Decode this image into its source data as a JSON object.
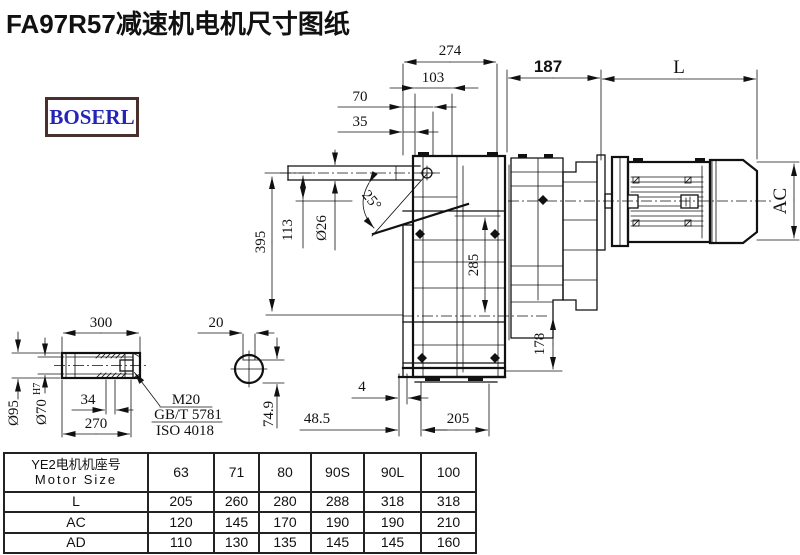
{
  "title": "FA97R57减速机电机尺寸图纸",
  "logo": "BOSERL",
  "colors": {
    "line": "#111111",
    "logo_text": "#2424b8",
    "logo_border": "#4a2f2f"
  },
  "dims": {
    "d274": "274",
    "d103": "103",
    "d70": "70",
    "d35": "35",
    "d187": "187",
    "dL": "L",
    "d395": "395",
    "d113": "113",
    "dia26": "Ø26",
    "angle25": "25°",
    "dAC": "AC",
    "d285": "285",
    "d178": "178",
    "d4": "4",
    "d48_5": "48.5",
    "d205": "205"
  },
  "shaft": {
    "d300": "300",
    "d20": "20",
    "dia95": "Ø95",
    "dia70": "Ø70",
    "dia70_sup": "H7",
    "d34": "34",
    "d270": "270",
    "d74_9": "74.9",
    "thread": "M20",
    "std1": "GB/T 5781",
    "std2": "ISO 4018"
  },
  "table": {
    "header_cn": "YE2电机机座号",
    "header_en": "Motor Size",
    "columns": [
      "63",
      "71",
      "80",
      "90S",
      "90L",
      "100"
    ],
    "rows": [
      {
        "label": "L",
        "values": [
          "205",
          "260",
          "280",
          "288",
          "318",
          "318"
        ]
      },
      {
        "label": "AC",
        "values": [
          "120",
          "145",
          "170",
          "190",
          "190",
          "210"
        ]
      },
      {
        "label": "AD",
        "values": [
          "110",
          "130",
          "135",
          "145",
          "145",
          "160"
        ]
      }
    ]
  }
}
